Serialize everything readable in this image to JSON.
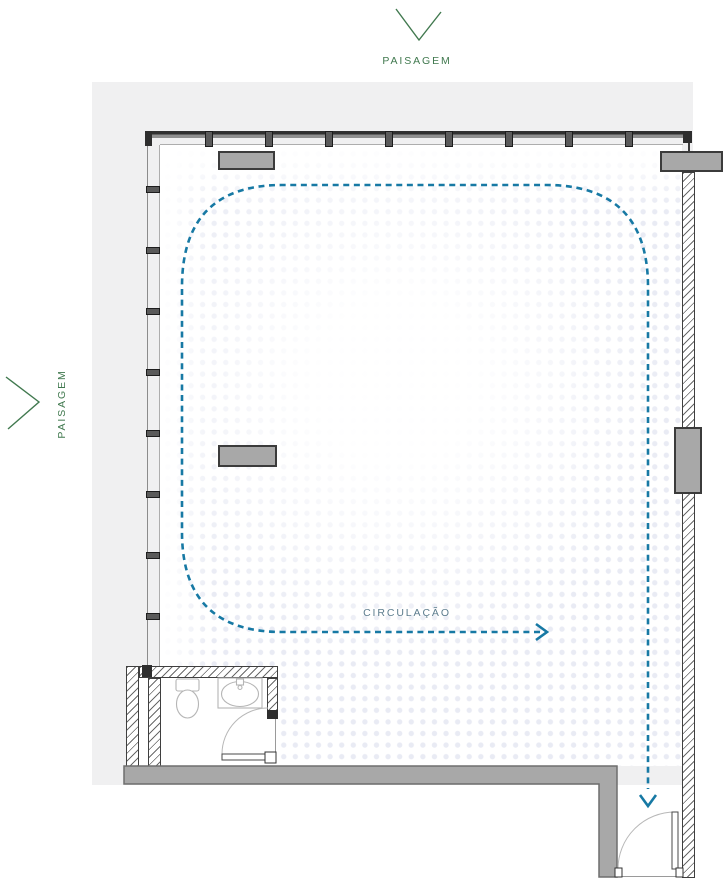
{
  "labels": {
    "landscape_top": "PAISAGEM",
    "landscape_left": "PAISAGEM",
    "circulation": "CIRCULAÇÃO"
  },
  "colors": {
    "landscape_green": "#41794F",
    "circulation_blue": "#1779A4",
    "circulation_label": "#5D7D8E",
    "backdrop_gray": "#F0F0F1",
    "wall_mid": "#8F8F8F",
    "column_gray": "#A8A8A8",
    "hatch_line": "#6A6A6A",
    "fixture_line": "#B5B5B5",
    "door_line": "#4A4A4A",
    "halftone_dot": "#E9EBF4"
  },
  "icons": {
    "top_direction": "chevron-down-icon",
    "left_direction": "chevron-right-icon",
    "circulation_end_right": "arrow-right-icon",
    "circulation_end_down": "arrow-down-icon"
  }
}
